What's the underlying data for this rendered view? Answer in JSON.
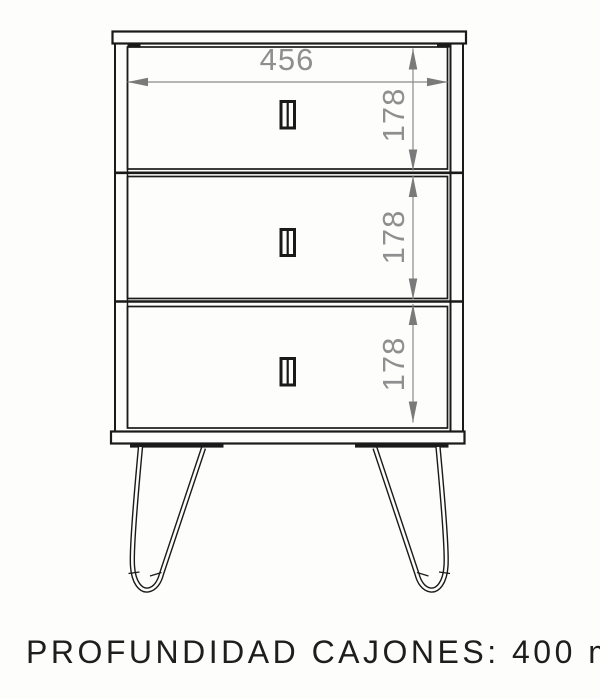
{
  "colors": {
    "background": "#fdfdfc",
    "line": "#1a1a1a",
    "dimension_line": "#8a8a8a",
    "dimension_arrow": "#7a7a7a",
    "dimension_text": "#8f8f8f",
    "caption_text": "#1e1e1e"
  },
  "diagram": {
    "type": "furniture technical drawing",
    "subject": "front elevation of a 3-drawer chest on hairpin legs"
  },
  "dimensions": {
    "width_mm": "456",
    "drawer_heights_mm": [
      "178",
      "178",
      "178"
    ]
  },
  "caption": {
    "text": "PROFUNDIDAD CAJONES: 400 mm."
  }
}
